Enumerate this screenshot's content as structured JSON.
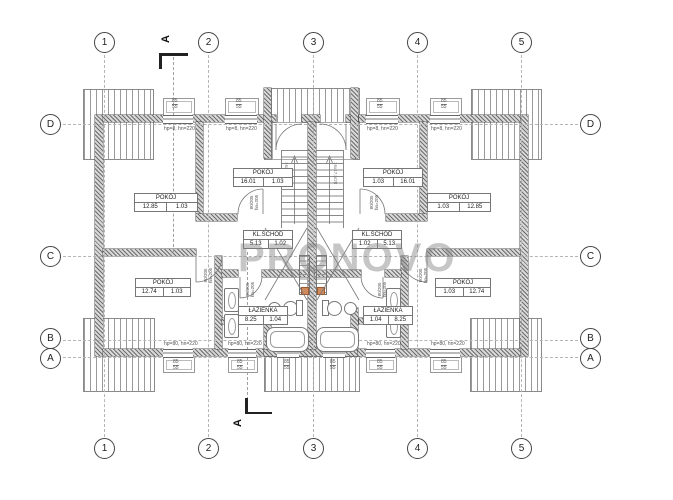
{
  "watermark": "PRONOVO",
  "grid": {
    "cols": [
      "1",
      "2",
      "3",
      "4",
      "5"
    ],
    "rows": [
      "D",
      "C",
      "B",
      "A"
    ]
  },
  "section": {
    "label": "A"
  },
  "rooms": [
    {
      "name": "POKÓJ",
      "v1": "12.85",
      "v2": "1.03"
    },
    {
      "name": "POKÓJ",
      "v1": "16.01",
      "v2": "1.03"
    },
    {
      "name": "KL.SCHOD",
      "v1": "5.13",
      "v2": "1.02"
    },
    {
      "name": "POKÓJ",
      "v1": "12.74",
      "v2": "1.03"
    },
    {
      "name": "ŁAZIENKA",
      "v1": "8.25",
      "v2": "1.04"
    },
    {
      "name": "POKÓJ",
      "v1": "1.03",
      "v2": "16.01"
    },
    {
      "name": "POKÓJ",
      "v1": "1.03",
      "v2": "12.85"
    },
    {
      "name": "KL.SCHOD",
      "v1": "1.02",
      "v2": "5.13"
    },
    {
      "name": "POKÓJ",
      "v1": "1.03",
      "v2": "12.74"
    },
    {
      "name": "ŁAZIENKA",
      "v1": "1.04",
      "v2": "8.25"
    }
  ],
  "notes": {
    "win_top": "hp=8, hn=220",
    "win_bottom": "hp=80, hn=220",
    "win_dim_top": "85",
    "win_dim_bottom": "55",
    "door_dim": "80/205",
    "door_sub": "hn=205",
    "stair_note": "16x17,5/28"
  }
}
